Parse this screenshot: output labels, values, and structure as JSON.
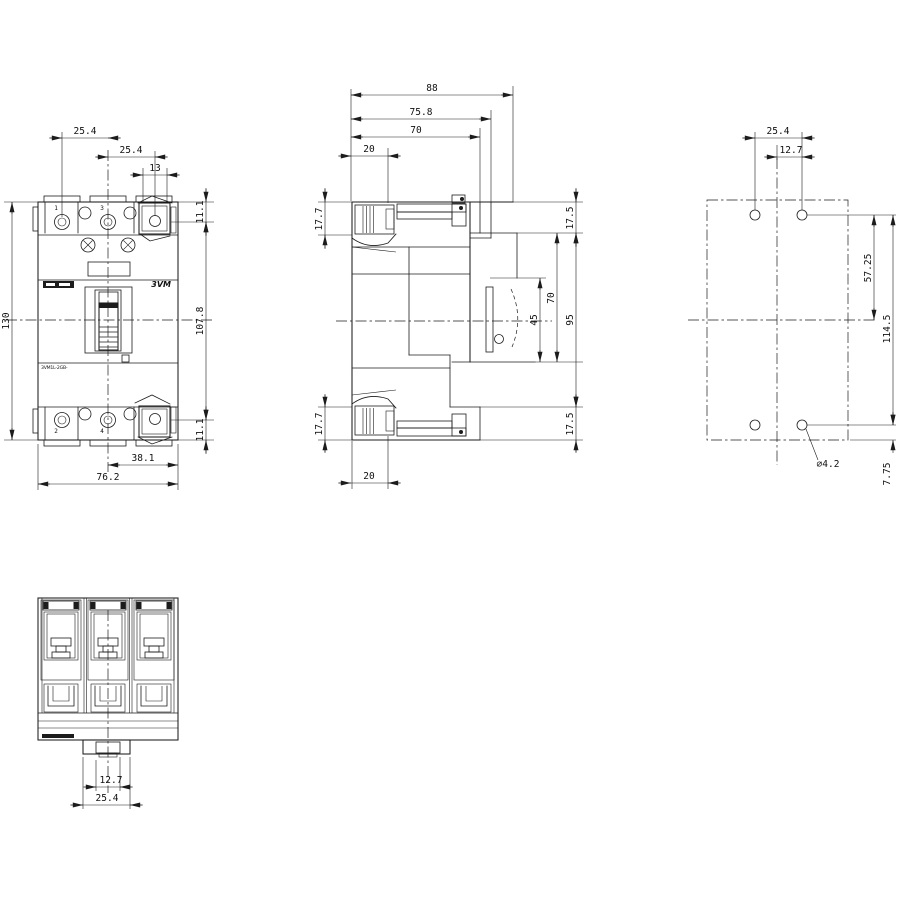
{
  "front": {
    "pitch1": "25.4",
    "pitch2": "25.4",
    "lug_hole_w": "13",
    "term_h_top": "11.1",
    "total_h": "130",
    "mid_h": "107.8",
    "term_h_bot": "11.1",
    "center_to_edge": "38.1",
    "total_w": "76.2",
    "brand": "3VM",
    "model": "3VM1L-2GB-",
    "pole_top_1": "1",
    "pole_top_3": "3",
    "pole_bot_2": "2",
    "pole_bot_4": "4"
  },
  "side": {
    "depth_total": "88",
    "depth_cover": "75.8",
    "depth_case": "70",
    "rear_top": "20",
    "h_177_top": "17.7",
    "h_175_top": "17.5",
    "front_h_70": "70",
    "front_h_45": "45",
    "front_h_95": "95",
    "h_175_bot": "17.5",
    "h_177_bot": "17.7",
    "rear_bot": "20"
  },
  "drill": {
    "pitch": "25.4",
    "half_pitch": "12.7",
    "upper_span": "57.25",
    "full_span": "114.5",
    "hole_dia": "⌀4.2",
    "bottom_offset": "7.75"
  },
  "bottom": {
    "inner_w": "12.7",
    "outer_w": "25.4"
  }
}
